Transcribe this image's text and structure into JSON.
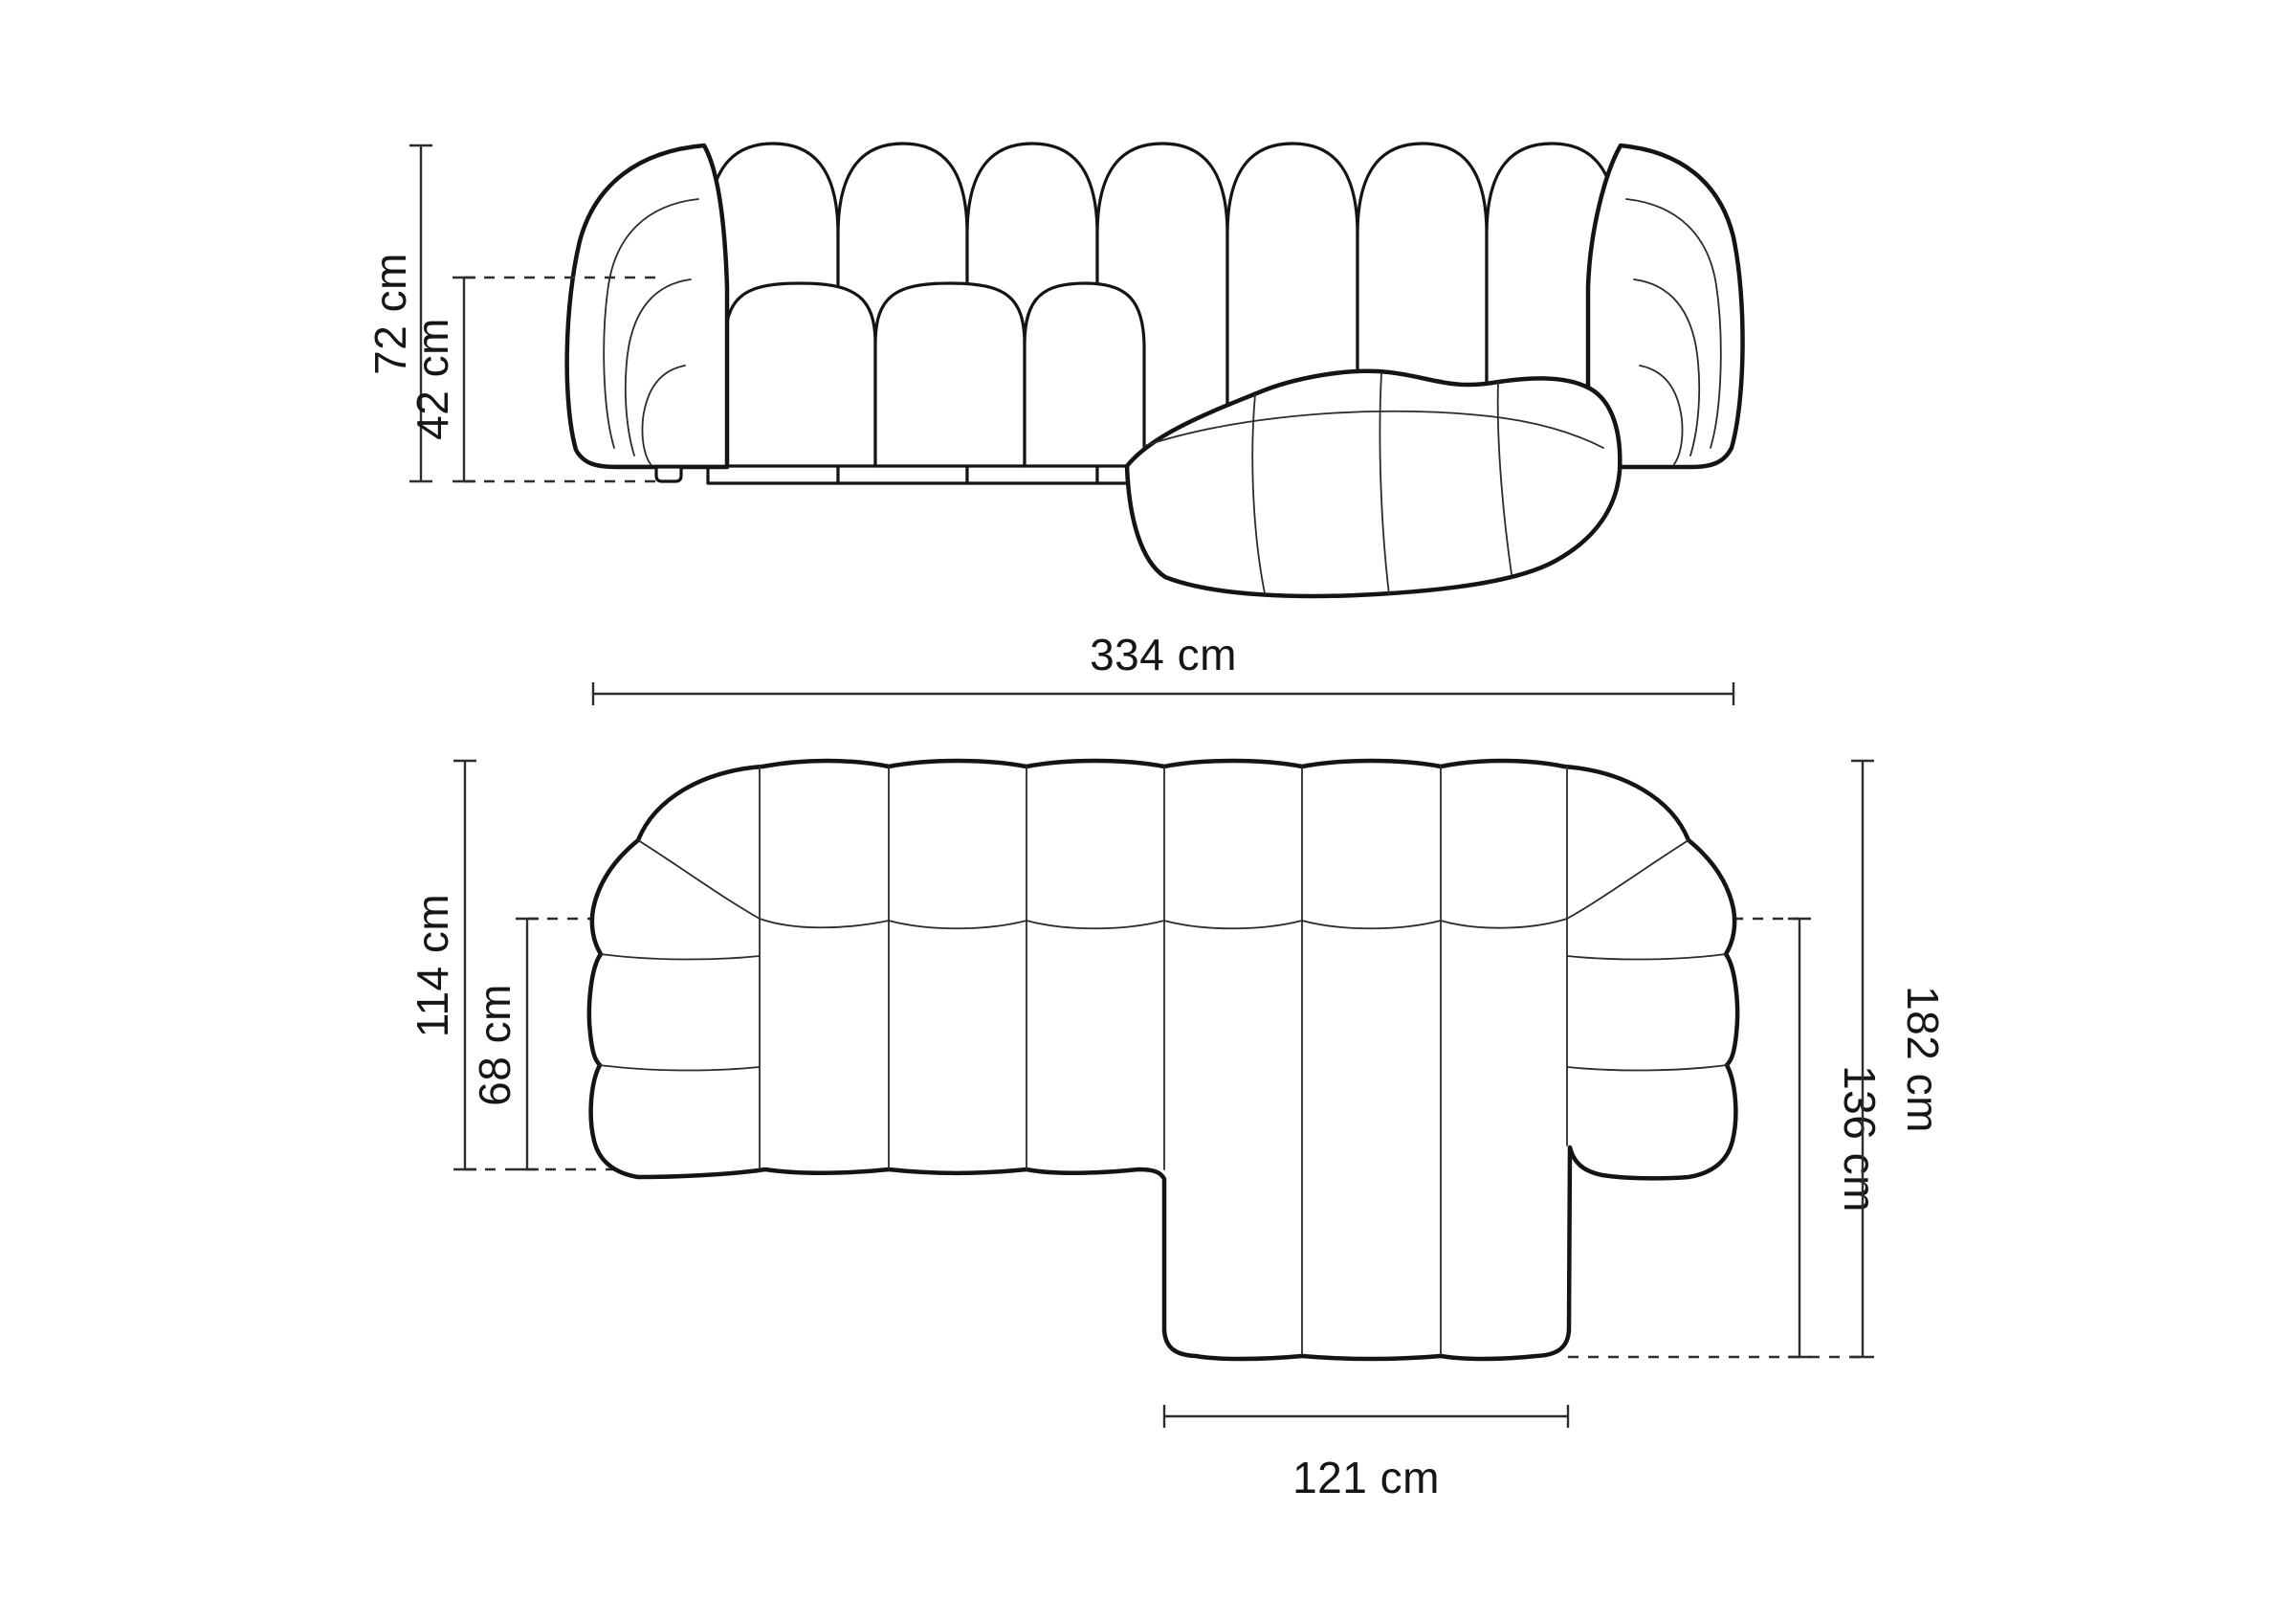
{
  "diagram": {
    "title": "corner-sofa-dimension-drawing",
    "front_view": {
      "overall_height_label": "72 cm",
      "seat_height_label": "42 cm"
    },
    "plan_view": {
      "overall_width_label": "334 cm",
      "body_depth_label": "114 cm",
      "seat_depth_label": "68 cm",
      "overall_depth_label": "182 cm",
      "chaise_depth_label": "136 cm",
      "chaise_width_label": "121 cm"
    },
    "style": {
      "background": "#ffffff",
      "line_color": "#141414",
      "dimension_color": "#2e2e2e"
    }
  }
}
